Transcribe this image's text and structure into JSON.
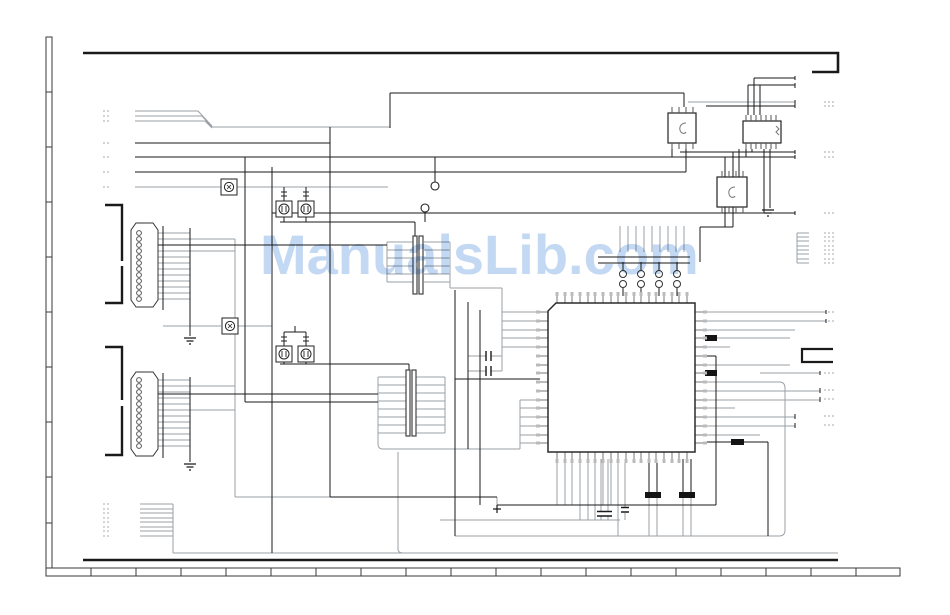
{
  "page": {
    "background": "#ffffff",
    "ink": "#1a1a1a",
    "secondary_ink": "#9aa0a6",
    "faint_ink": "#b8b8b8"
  },
  "watermark": {
    "text": "ManualsLib.com",
    "color": "#c3d8f2"
  },
  "components": [
    "left-ruler-scale",
    "bottom-ruler-scale",
    "sheet-border-top",
    "sheet-border-bottom",
    "upper-pin-connector",
    "lower-pin-connector",
    "connector-bracket-upper",
    "connector-bracket-lower",
    "transformer-1",
    "transformer-2",
    "main-qfp-ic",
    "small-ic-a",
    "dip-ic",
    "small-ic-c",
    "optocoupler-1",
    "optocoupler-2",
    "transistor-pair-upper",
    "transistor-pair-lower",
    "transistor-array",
    "resistor-comb",
    "capacitors",
    "ground-symbols",
    "test-points",
    "offpage-reference-dashes",
    "right-edge-bracket"
  ]
}
